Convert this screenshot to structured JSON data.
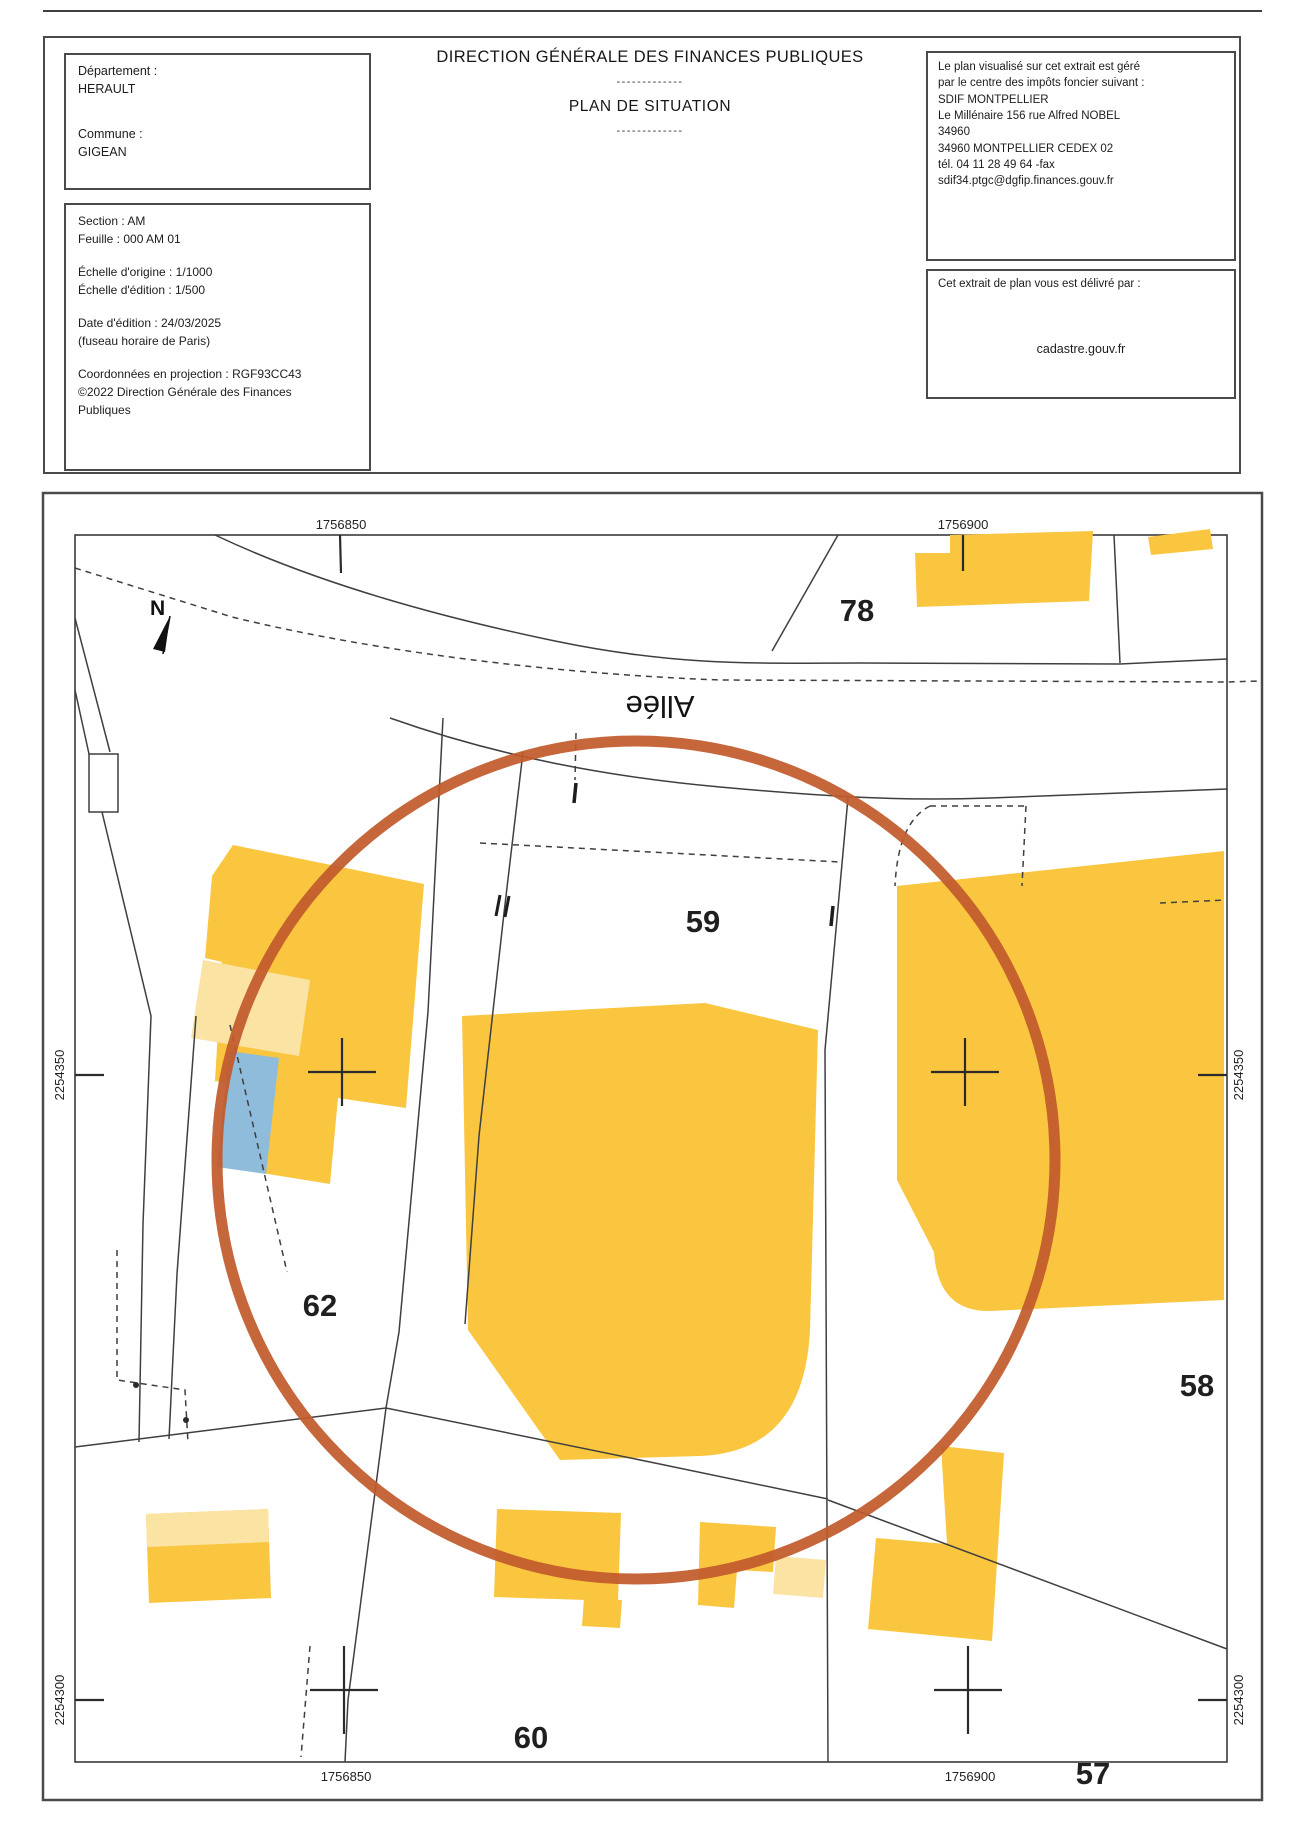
{
  "header": {
    "left_box1": {
      "dept_label": "Département :",
      "dept_value": "HERAULT",
      "commune_label": "Commune :",
      "commune_value": "GIGEAN"
    },
    "left_box2": {
      "section": "Section : AM",
      "feuille": "Feuille : 000 AM 01",
      "echelle_origine": "Échelle d'origine : 1/1000",
      "echelle_edition": "Échelle d'édition : 1/500",
      "date_edition": "Date d'édition : 24/03/2025",
      "fuseau": "(fuseau horaire de Paris)",
      "coordonnees": "Coordonnées en projection : RGF93CC43",
      "copyright_l1": "©2022 Direction Générale des Finances",
      "copyright_l2": "Publiques"
    },
    "title": "DIRECTION GÉNÉRALE DES FINANCES PUBLIQUES",
    "separator1": "-------------",
    "subtitle": "PLAN DE SITUATION",
    "separator2": "-------------",
    "right_box1": {
      "l1": "Le plan visualisé sur cet extrait est géré",
      "l2": "par le centre des impôts foncier suivant :",
      "l3": "SDIF MONTPELLIER",
      "l4": "Le Millénaire 156 rue Alfred NOBEL",
      "l5": "34960",
      "l6": "34960 MONTPELLIER CEDEX 02",
      "l7": "tél. 04 11 28 49 64 -fax",
      "l8": "sdif34.ptgc@dgfip.finances.gouv.fr"
    },
    "right_box2": {
      "intro": "Cet extrait de plan vous est délivré par :",
      "site": "cadastre.gouv.fr"
    }
  },
  "map": {
    "north_label": "N",
    "road_label": "Allée",
    "parcels": [
      {
        "label": "78"
      },
      {
        "label": "59"
      },
      {
        "label": "62"
      },
      {
        "label": "58"
      },
      {
        "label": "60"
      },
      {
        "label": "57"
      }
    ],
    "coords": {
      "top_left": "1756850",
      "top_right": "1756900",
      "bottom_left": "1756850",
      "bottom_right": "1756900",
      "left_upper": "2254350",
      "left_lower": "2254300",
      "right_upper": "2254350",
      "right_lower": "2254300"
    }
  },
  "colors": {
    "building": "#FAC63F",
    "building_light": "#FBE3A4",
    "pool_blue": "#8FBCDB",
    "highlight_circle": "#C25A2C",
    "line": "#3f3f3f"
  }
}
